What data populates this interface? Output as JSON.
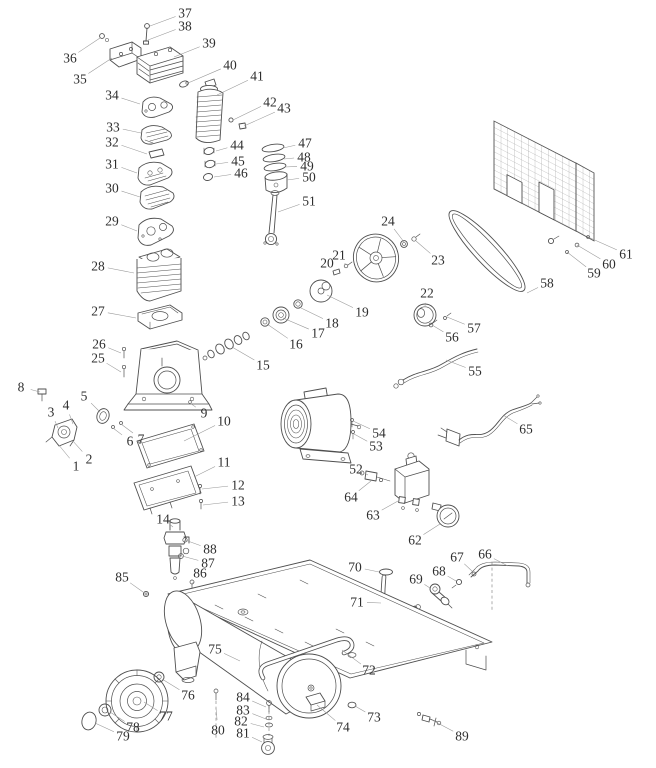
{
  "diagram": {
    "type": "exploded-parts-diagram",
    "subject": "air-compressor",
    "colors": {
      "background": "#ffffff",
      "line": "#4f4f4f",
      "label": "#2e2e2e",
      "leader": "#979797"
    },
    "labels": [
      {
        "n": "1",
        "x": 76,
        "y": 466,
        "tx": 58,
        "ty": 444
      },
      {
        "n": "2",
        "x": 89,
        "y": 459,
        "tx": 72,
        "ty": 440
      },
      {
        "n": "3",
        "x": 51,
        "y": 412,
        "tx": 58,
        "ty": 428
      },
      {
        "n": "4",
        "x": 66,
        "y": 405,
        "tx": 73,
        "ty": 424
      },
      {
        "n": "5",
        "x": 84,
        "y": 396,
        "tx": 100,
        "ty": 412
      },
      {
        "n": "6",
        "x": 130,
        "y": 441,
        "tx": 113,
        "ty": 428
      },
      {
        "n": "7",
        "x": 141,
        "y": 439,
        "tx": 121,
        "ty": 424
      },
      {
        "n": "8",
        "x": 21,
        "y": 387,
        "tx": 40,
        "ty": 392
      },
      {
        "n": "9",
        "x": 204,
        "y": 413,
        "tx": 190,
        "ty": 403
      },
      {
        "n": "10",
        "x": 224,
        "y": 421,
        "tx": 184,
        "ty": 441
      },
      {
        "n": "11",
        "x": 224,
        "y": 462,
        "tx": 194,
        "ty": 477
      },
      {
        "n": "12",
        "x": 238,
        "y": 485,
        "tx": 202,
        "ty": 489
      },
      {
        "n": "13",
        "x": 238,
        "y": 501,
        "tx": 203,
        "ty": 505
      },
      {
        "n": "14",
        "x": 163,
        "y": 519,
        "tx": 173,
        "ty": 527
      },
      {
        "n": "15",
        "x": 263,
        "y": 365,
        "tx": 232,
        "ty": 347
      },
      {
        "n": "16",
        "x": 296,
        "y": 344,
        "tx": 267,
        "ty": 324
      },
      {
        "n": "17",
        "x": 318,
        "y": 333,
        "tx": 283,
        "ty": 318
      },
      {
        "n": "18",
        "x": 332,
        "y": 323,
        "tx": 299,
        "ty": 307
      },
      {
        "n": "19",
        "x": 362,
        "y": 312,
        "tx": 327,
        "ty": 295
      },
      {
        "n": "20",
        "x": 327,
        "y": 263,
        "tx": 336,
        "ty": 271
      },
      {
        "n": "21",
        "x": 339,
        "y": 255,
        "tx": 346,
        "ty": 265
      },
      {
        "n": "22",
        "x": 427,
        "y": 293,
        "tx": 425,
        "ty": 306
      },
      {
        "n": "23",
        "x": 438,
        "y": 260,
        "tx": 416,
        "ty": 241
      },
      {
        "n": "24",
        "x": 388,
        "y": 221,
        "tx": 404,
        "ty": 242
      },
      {
        "n": "25",
        "x": 98,
        "y": 358,
        "tx": 121,
        "ty": 372
      },
      {
        "n": "26",
        "x": 99,
        "y": 344,
        "tx": 121,
        "ty": 353
      },
      {
        "n": "27",
        "x": 98,
        "y": 311,
        "tx": 136,
        "ty": 318
      },
      {
        "n": "28",
        "x": 98,
        "y": 266,
        "tx": 134,
        "ty": 273
      },
      {
        "n": "29",
        "x": 112,
        "y": 221,
        "tx": 137,
        "ty": 231
      },
      {
        "n": "30",
        "x": 112,
        "y": 188,
        "tx": 140,
        "ty": 197
      },
      {
        "n": "31",
        "x": 112,
        "y": 164,
        "tx": 137,
        "ty": 173
      },
      {
        "n": "32",
        "x": 112,
        "y": 142,
        "tx": 147,
        "ty": 154
      },
      {
        "n": "33",
        "x": 113,
        "y": 127,
        "tx": 141,
        "ty": 133
      },
      {
        "n": "34",
        "x": 112,
        "y": 95,
        "tx": 140,
        "ty": 104
      },
      {
        "n": "35",
        "x": 80,
        "y": 79,
        "tx": 112,
        "ty": 58
      },
      {
        "n": "36",
        "x": 70,
        "y": 58,
        "tx": 100,
        "ty": 38
      },
      {
        "n": "37",
        "x": 185,
        "y": 13,
        "tx": 150,
        "ty": 26
      },
      {
        "n": "38",
        "x": 185,
        "y": 26,
        "tx": 148,
        "ty": 40
      },
      {
        "n": "39",
        "x": 209,
        "y": 43,
        "tx": 174,
        "ty": 57
      },
      {
        "n": "40",
        "x": 230,
        "y": 65,
        "tx": 188,
        "ty": 83
      },
      {
        "n": "41",
        "x": 257,
        "y": 76,
        "tx": 217,
        "ty": 95
      },
      {
        "n": "42",
        "x": 270,
        "y": 102,
        "tx": 233,
        "ty": 120
      },
      {
        "n": "43",
        "x": 284,
        "y": 108,
        "tx": 244,
        "ty": 126
      },
      {
        "n": "44",
        "x": 237,
        "y": 145,
        "tx": 216,
        "ty": 151
      },
      {
        "n": "45",
        "x": 238,
        "y": 161,
        "tx": 216,
        "ty": 164
      },
      {
        "n": "46",
        "x": 241,
        "y": 173,
        "tx": 214,
        "ty": 177
      },
      {
        "n": "47",
        "x": 305,
        "y": 143,
        "tx": 283,
        "ty": 148
      },
      {
        "n": "48",
        "x": 304,
        "y": 157,
        "tx": 284,
        "ty": 159
      },
      {
        "n": "49",
        "x": 307,
        "y": 166,
        "tx": 285,
        "ty": 167
      },
      {
        "n": "50",
        "x": 309,
        "y": 177,
        "tx": 287,
        "ty": 180
      },
      {
        "n": "51",
        "x": 309,
        "y": 201,
        "tx": 278,
        "ty": 212
      },
      {
        "n": "52",
        "x": 356,
        "y": 469,
        "tx": 368,
        "ty": 475
      },
      {
        "n": "53",
        "x": 376,
        "y": 446,
        "tx": 354,
        "ty": 434
      },
      {
        "n": "54",
        "x": 379,
        "y": 433,
        "tx": 353,
        "ty": 421
      },
      {
        "n": "55",
        "x": 475,
        "y": 371,
        "tx": 446,
        "ty": 360
      },
      {
        "n": "56",
        "x": 452,
        "y": 337,
        "tx": 432,
        "ty": 325
      },
      {
        "n": "57",
        "x": 474,
        "y": 328,
        "tx": 447,
        "ty": 317
      },
      {
        "n": "58",
        "x": 547,
        "y": 283,
        "tx": 527,
        "ty": 293
      },
      {
        "n": "59",
        "x": 594,
        "y": 273,
        "tx": 567,
        "ty": 252
      },
      {
        "n": "60",
        "x": 609,
        "y": 264,
        "tx": 577,
        "ty": 245
      },
      {
        "n": "61",
        "x": 626,
        "y": 254,
        "tx": 588,
        "ty": 237
      },
      {
        "n": "62",
        "x": 415,
        "y": 540,
        "tx": 440,
        "ty": 524
      },
      {
        "n": "63",
        "x": 373,
        "y": 515,
        "tx": 398,
        "ty": 501
      },
      {
        "n": "64",
        "x": 351,
        "y": 497,
        "tx": 371,
        "ty": 481
      },
      {
        "n": "65",
        "x": 526,
        "y": 429,
        "tx": 503,
        "ty": 415
      },
      {
        "n": "66",
        "x": 485,
        "y": 554,
        "tx": 508,
        "ty": 566
      },
      {
        "n": "67",
        "x": 457,
        "y": 557,
        "tx": 473,
        "ty": 572
      },
      {
        "n": "68",
        "x": 439,
        "y": 571,
        "tx": 456,
        "ty": 581
      },
      {
        "n": "69",
        "x": 416,
        "y": 579,
        "tx": 430,
        "ty": 588
      },
      {
        "n": "70",
        "x": 355,
        "y": 567,
        "tx": 379,
        "ty": 572
      },
      {
        "n": "71",
        "x": 357,
        "y": 602,
        "tx": 381,
        "ty": 603
      },
      {
        "n": "72",
        "x": 369,
        "y": 670,
        "tx": 342,
        "ty": 650
      },
      {
        "n": "73",
        "x": 374,
        "y": 717,
        "tx": 355,
        "ty": 706
      },
      {
        "n": "74",
        "x": 343,
        "y": 727,
        "tx": 317,
        "ty": 705
      },
      {
        "n": "75",
        "x": 215,
        "y": 649,
        "tx": 240,
        "ty": 661
      },
      {
        "n": "76",
        "x": 188,
        "y": 695,
        "tx": 162,
        "ty": 679
      },
      {
        "n": "77",
        "x": 166,
        "y": 716,
        "tx": 144,
        "ty": 702
      },
      {
        "n": "78",
        "x": 133,
        "y": 727,
        "tx": 110,
        "ty": 712
      },
      {
        "n": "79",
        "x": 123,
        "y": 736,
        "tx": 95,
        "ty": 723
      },
      {
        "n": "80",
        "x": 218,
        "y": 730,
        "tx": 216,
        "ty": 708
      },
      {
        "n": "81",
        "x": 243,
        "y": 733,
        "tx": 262,
        "ty": 742
      },
      {
        "n": "82",
        "x": 241,
        "y": 721,
        "tx": 264,
        "ty": 727
      },
      {
        "n": "83",
        "x": 243,
        "y": 710,
        "tx": 266,
        "ty": 719
      },
      {
        "n": "84",
        "x": 243,
        "y": 697,
        "tx": 266,
        "ty": 707
      },
      {
        "n": "85",
        "x": 122,
        "y": 577,
        "tx": 143,
        "ty": 592
      },
      {
        "n": "86",
        "x": 200,
        "y": 573,
        "tx": 192,
        "ty": 584
      },
      {
        "n": "87",
        "x": 208,
        "y": 563,
        "tx": 182,
        "ty": 556
      },
      {
        "n": "88",
        "x": 210,
        "y": 549,
        "tx": 185,
        "ty": 540
      },
      {
        "n": "89",
        "x": 462,
        "y": 736,
        "tx": 432,
        "ty": 720
      }
    ]
  }
}
